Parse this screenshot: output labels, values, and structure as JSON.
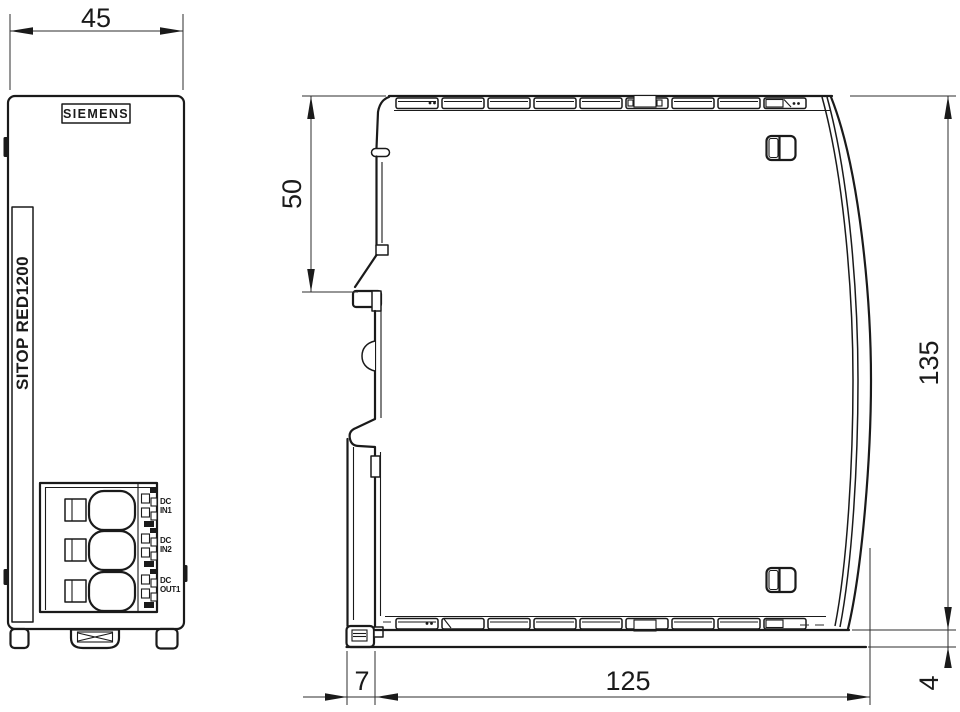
{
  "colors": {
    "line": "#1a1a1a",
    "background": "#ffffff"
  },
  "front_view": {
    "brand_logo": "SIEMENS",
    "product_label": "SITOP RED1200",
    "dim_width": "45",
    "terminals": [
      {
        "line1": "DC",
        "line2": "IN1"
      },
      {
        "line1": "DC",
        "line2": "IN2"
      },
      {
        "line1": "DC",
        "line2": "OUT1"
      }
    ]
  },
  "side_view": {
    "dim_din_rail_top_offset": "50",
    "dim_height": "135",
    "dim_depth": "125",
    "dim_rail_recess": "7",
    "dim_base_height": "4"
  }
}
